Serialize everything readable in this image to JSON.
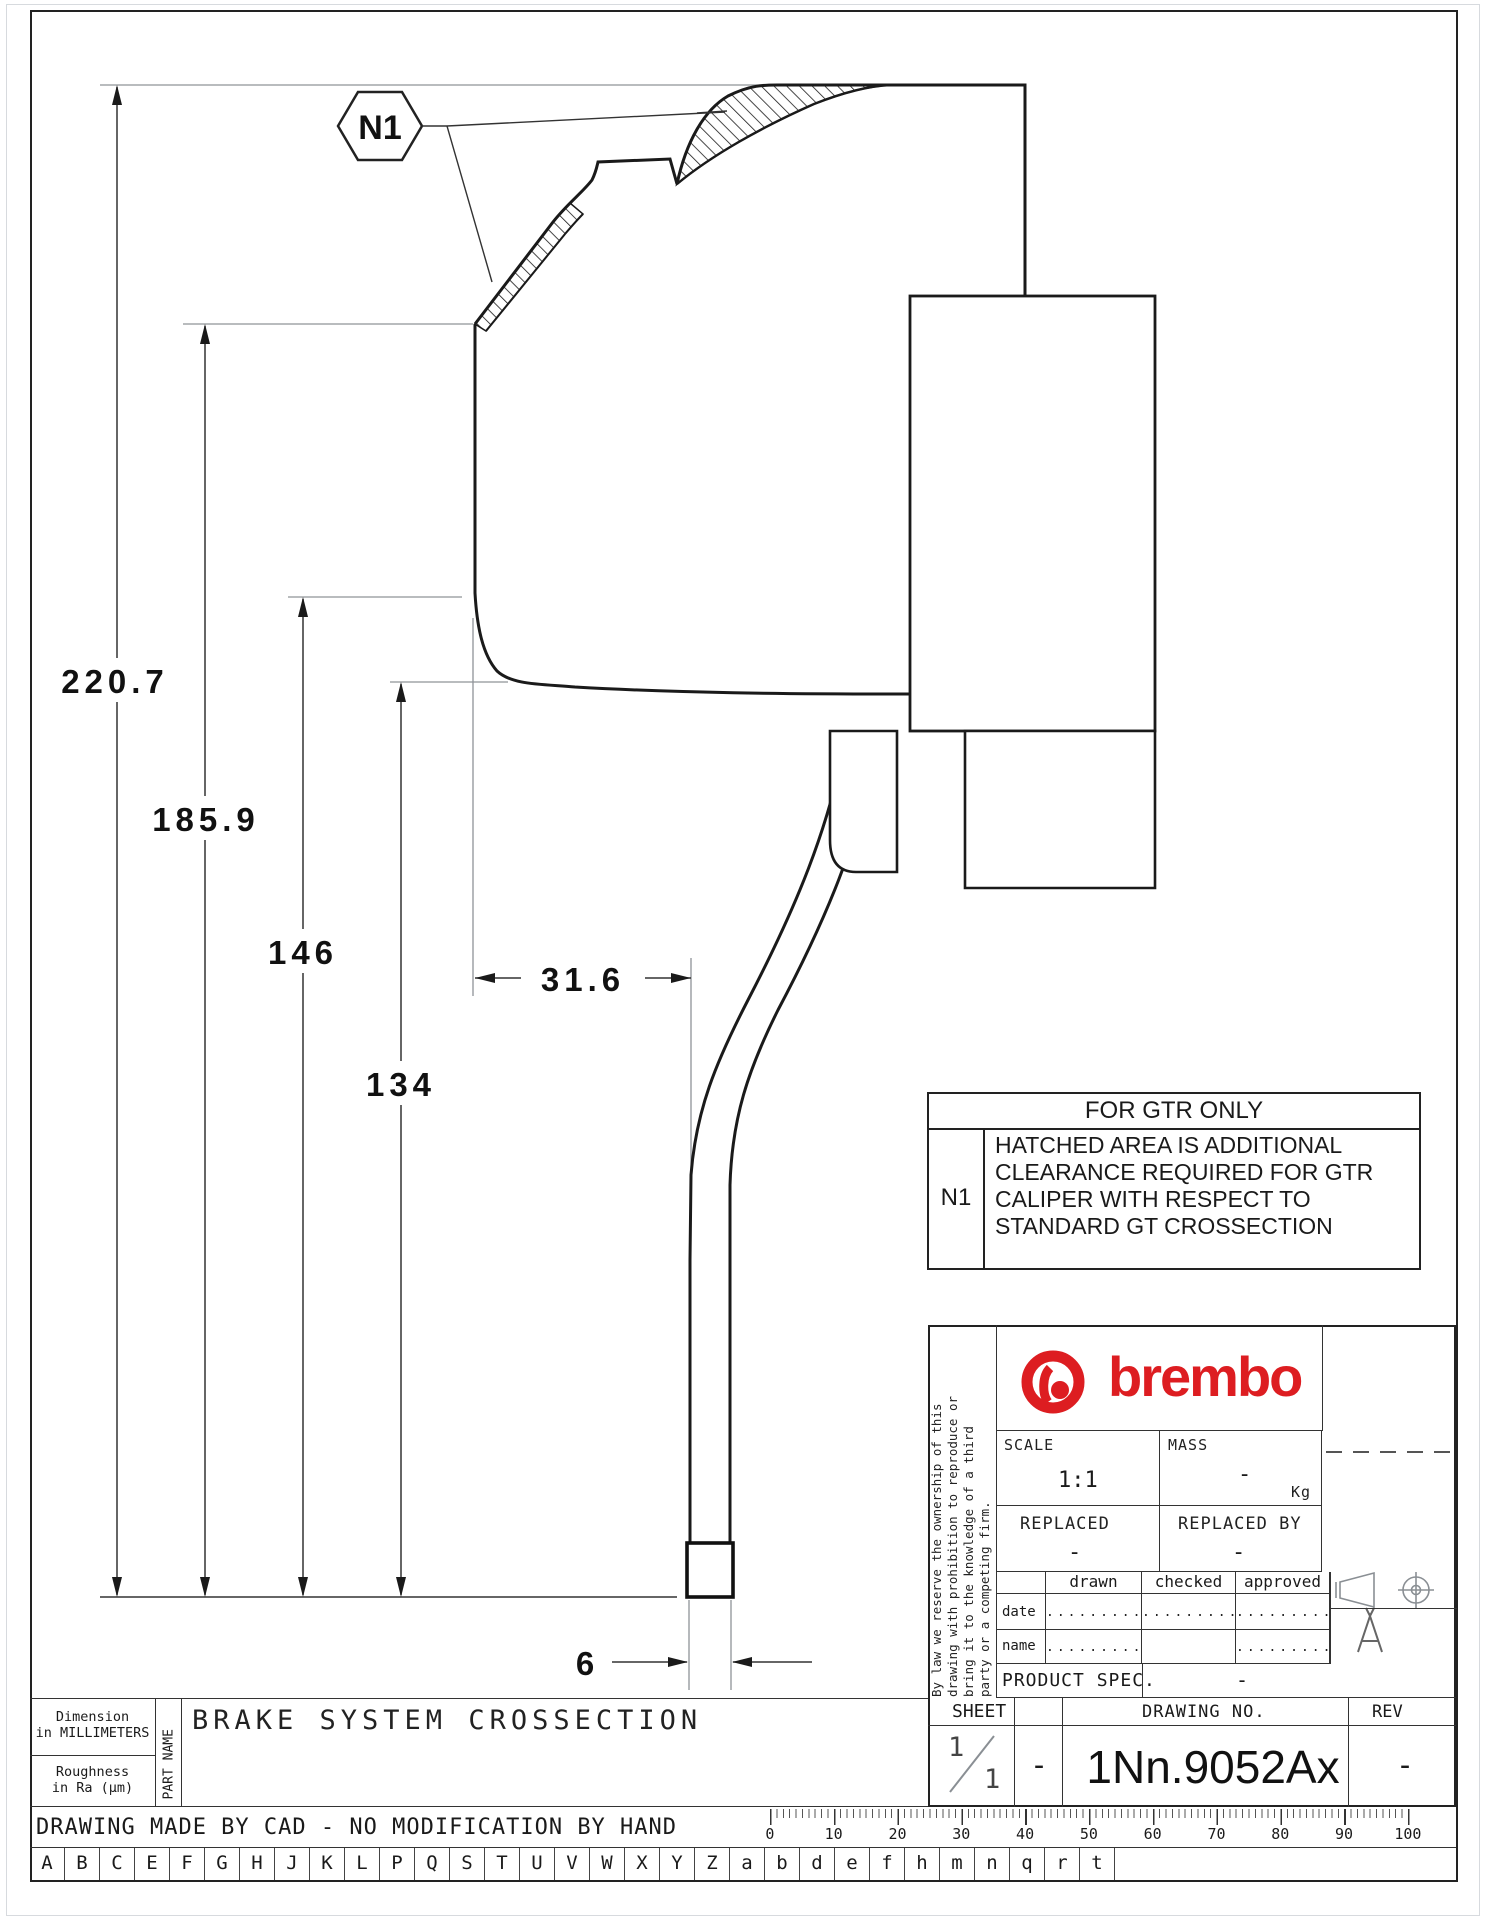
{
  "drawing": {
    "callout": "N1",
    "dimensions": {
      "d220": "220.7",
      "d185": "185.9",
      "d146": "146",
      "d134": "134",
      "d31": "31.6",
      "d6": "6"
    },
    "gtr_table": {
      "title": "FOR GTR ONLY",
      "ref": "N1",
      "note_line1": "HATCHED AREA IS ADDITIONAL",
      "note_line2": "CLEARANCE REQUIRED FOR GTR",
      "note_line3": "CALIPER WITH RESPECT TO",
      "note_line4": "STANDARD GT CROSSECTION"
    }
  },
  "title_block": {
    "brand": "brembo",
    "legal_line1": "By law we reserve the ownership of this",
    "legal_line2": "drawing with prohibition to reproduce or",
    "legal_line3": "bring it to the knowledge of a third",
    "legal_line4": "party or a competing firm.",
    "scale_label": "SCALE",
    "scale_value": "1:1",
    "mass_label": "MASS",
    "mass_value": "-",
    "mass_unit": "Kg",
    "replaced_label": "REPLACED",
    "replaced_value": "-",
    "replaced_by_label": "REPLACED BY",
    "replaced_by_value": "-",
    "col_drawn": "drawn",
    "col_checked": "checked",
    "col_approved": "approved",
    "row_date": "date",
    "row_name": "name",
    "date_drawn": ".........",
    "date_checked": ".........",
    "date_approved": ".........",
    "name_drawn": ".........",
    "name_checked": "",
    "name_approved": ".........",
    "product_spec_label": "PRODUCT SPEC.",
    "product_spec_value": "-",
    "sheet_label": "SHEET",
    "sheet_num": "1",
    "sheet_den": "1",
    "sheet_dash": "-",
    "drawing_no_label": "DRAWING NO.",
    "drawing_no": "1Nn.9052Ax",
    "rev_label": "REV",
    "rev_value": "-",
    "format_mark": "A"
  },
  "footer": {
    "dimension_note_1": "Dimension",
    "dimension_note_2": "in MILLIMETERS",
    "roughness_1": "Roughness",
    "roughness_2": "in Ra (μm)",
    "part_name_label": "PART NAME",
    "part_name": "BRAKE SYSTEM CROSSECTION",
    "cad_note": "DRAWING MADE BY CAD - NO MODIFICATION BY HAND",
    "ruler_numbers": [
      "0",
      "10",
      "20",
      "30",
      "40",
      "50",
      "60",
      "70",
      "80",
      "90",
      "100"
    ],
    "letters": [
      "A",
      "B",
      "C",
      "E",
      "F",
      "G",
      "H",
      "J",
      "K",
      "L",
      "P",
      "Q",
      "S",
      "T",
      "U",
      "V",
      "W",
      "X",
      "Y",
      "Z",
      "a",
      "b",
      "d",
      "e",
      "f",
      "h",
      "m",
      "n",
      "q",
      "r",
      "t"
    ]
  },
  "colors": {
    "brand_red": "#dd1d21",
    "line_dark": "#1a1a1a",
    "line_gray": "#8f9398"
  }
}
